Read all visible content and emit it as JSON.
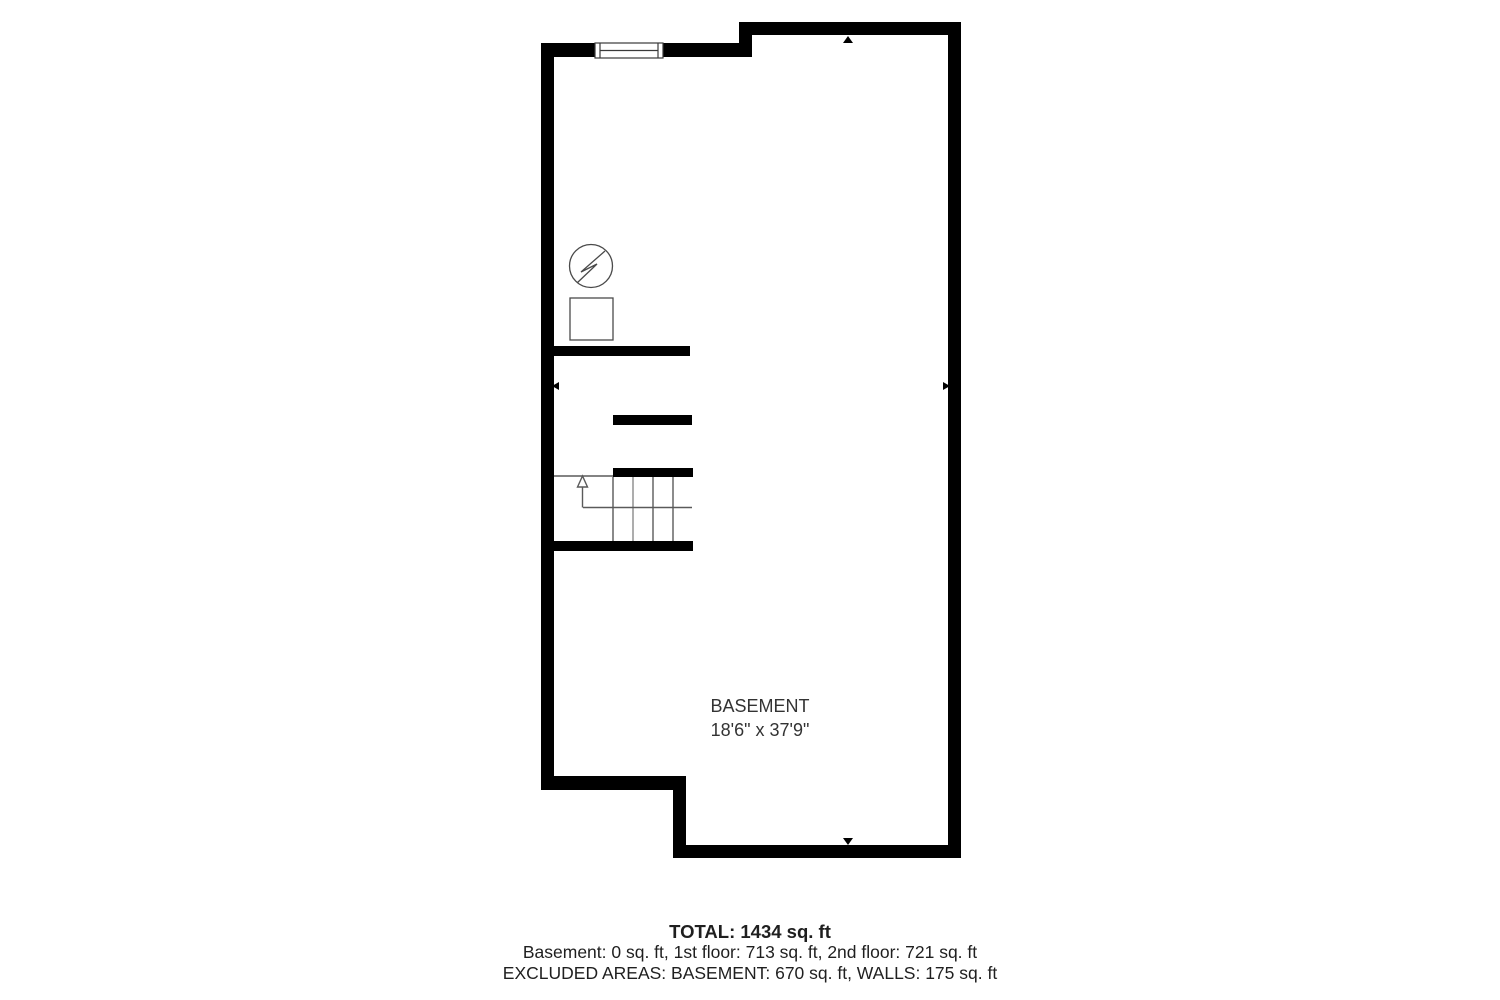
{
  "floorplan": {
    "room": {
      "label": "BASEMENT",
      "dimensions": "18'6\" x 37'9\""
    },
    "symbols": [
      {
        "name": "water-heater-icon",
        "glyph": "circle-with-lightning-bolt"
      },
      {
        "name": "utility-unit-icon",
        "glyph": "square-outline"
      },
      {
        "name": "stair-direction-arrow",
        "glyph": "up-arrow"
      },
      {
        "name": "marker-arrow-top",
        "glyph": "black-triangle-up"
      },
      {
        "name": "marker-arrow-bottom",
        "glyph": "black-triangle-down"
      },
      {
        "name": "marker-arrow-left",
        "glyph": "black-triangle-left"
      },
      {
        "name": "marker-arrow-right",
        "glyph": "black-triangle-right"
      }
    ],
    "colors": {
      "wall": "#000000",
      "thin_line": "#4a4a4a",
      "text": "#333333",
      "background": "#ffffff"
    }
  },
  "summary": {
    "total": "TOTAL: 1434 sq. ft",
    "floors": "Basement: 0 sq. ft, 1st floor: 713 sq. ft, 2nd floor: 721 sq. ft",
    "excluded": "EXCLUDED AREAS: BASEMENT: 670 sq. ft, WALLS: 175 sq. ft"
  }
}
